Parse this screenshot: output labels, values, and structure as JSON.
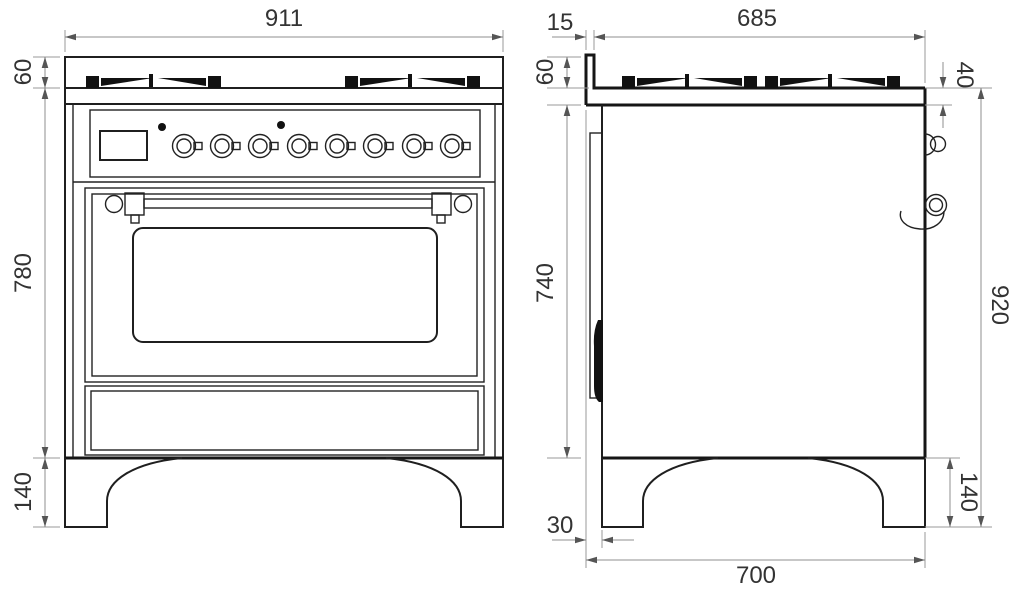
{
  "drawing": {
    "subject": "freestanding range cooker technical drawing, front and side elevations",
    "units": "mm",
    "front_view": {
      "features": {
        "burner_grate_groups": 2,
        "control_knobs": 8,
        "indicator_lights": 2,
        "display_window": 1,
        "oven_door_with_handle": 1,
        "storage_drawer": 1,
        "legs": 2
      },
      "dimensions": {
        "overall_width": "911",
        "cooktop_rim_height": "60",
        "body_height": "780",
        "leg_height": "140"
      }
    },
    "side_view": {
      "features": {
        "front_lip": 1,
        "gas_inlet": 1,
        "power_cord_loop": 1,
        "legs": 2
      },
      "dimensions": {
        "front_lip_depth": "15",
        "cooktop_depth": "685",
        "cooktop_rim_height": "60",
        "cooktop_edge_thickness": "40",
        "body_height": "740",
        "overall_height": "920",
        "leg_height": "140",
        "door_front_offset": "30",
        "overall_depth": "700"
      }
    },
    "colors": {
      "line": "#1f1f1f",
      "dimension_line": "#8f8f8f",
      "text": "#333333",
      "background": "#ffffff"
    }
  }
}
